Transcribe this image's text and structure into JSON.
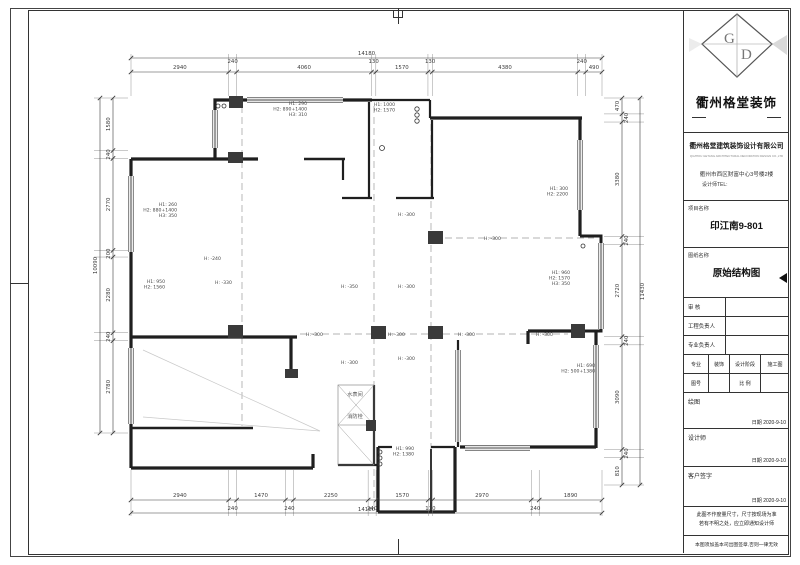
{
  "sheet": {
    "title_block": {
      "logo_letters": [
        "G",
        "D"
      ],
      "logo_text": "衢州格堂装饰",
      "company_name": "衢州格堂建筑装饰设计有限公司",
      "company_sub": "QUZHOU GETANG ARCHITECTURAL DECORATION DESIGN CO.,LTD",
      "address": "衢州市西区财富中心3号楼2楼",
      "tel_label": "设计师TEL:",
      "project_label": "项目名称",
      "project_name": "印江南9-801",
      "drawing_label": "图纸名称",
      "drawing_name": "原始结构图",
      "personnel_rows": [
        {
          "label": "审  核",
          "value": ""
        },
        {
          "label": "工程负责人",
          "value": ""
        },
        {
          "label": "专业负责人",
          "value": ""
        }
      ],
      "grid": {
        "major_label": "专业",
        "major_value": "装饰",
        "stage_label": "设计阶段",
        "stage_value": "施工图",
        "no_label": "图号",
        "no_value": "",
        "scale_label": "比 例",
        "scale_value": ""
      },
      "sign_boxes": [
        {
          "label": "绘图",
          "date_label": "日期",
          "date": "2020-9-10"
        },
        {
          "label": "设计师",
          "date_label": "日期",
          "date": "2020-9-10"
        },
        {
          "label": "客户签字",
          "date_label": "日期",
          "date": "2020-9-10"
        }
      ],
      "notes": [
        "此图不作度量尺寸，尺寸按现场为准",
        "若有不明之处，应立即通知设计师"
      ],
      "footer": "本图须加盖本司出图签章,否则一律无效"
    }
  },
  "plan": {
    "dimensions": {
      "top": {
        "overall": "14180",
        "segments": [
          "2940",
          "240",
          "4060",
          "130",
          "1570",
          "130",
          "4380",
          "240",
          "490"
        ]
      },
      "bottom": {
        "overall": "14180",
        "segments": [
          "2940",
          "240",
          "1470",
          "240",
          "2250",
          "240",
          "1570",
          "130",
          "2970",
          "240",
          "1890"
        ]
      },
      "left": {
        "overall": "10090",
        "segments": [
          "1580",
          "240",
          "2770",
          "200",
          "2280",
          "240",
          "2780"
        ]
      },
      "right": {
        "overall": "11430",
        "segments": [
          "470",
          "240",
          "3380",
          "240",
          "2720",
          "240",
          "3090",
          "240",
          "810"
        ]
      }
    },
    "beam_notes": [
      {
        "x": 307,
        "y": 105,
        "lines": [
          "H1: 290",
          "H2: 890+1400",
          "H3: 310"
        ]
      },
      {
        "x": 395,
        "y": 106,
        "lines": [
          "H1: 1000",
          "H2: 1570"
        ]
      },
      {
        "x": 177,
        "y": 206,
        "lines": [
          "H1: 260",
          "H2: 880+1400",
          "H3: 350"
        ]
      },
      {
        "x": 165,
        "y": 283,
        "lines": [
          "H1: 950",
          "H2: 1560"
        ]
      },
      {
        "x": 568,
        "y": 190,
        "lines": [
          "H1: 300",
          "H2: 2200"
        ]
      },
      {
        "x": 570,
        "y": 274,
        "lines": [
          "H1: 960",
          "H2: 1570",
          "H3: 350"
        ]
      },
      {
        "x": 595,
        "y": 367,
        "lines": [
          "H1: 690",
          "H2: 500+1380"
        ]
      },
      {
        "x": 414,
        "y": 450,
        "lines": [
          "H1: 990",
          "H2: 1380"
        ]
      }
    ],
    "level_notes": [
      {
        "x": 204,
        "y": 260,
        "text": "H: -240"
      },
      {
        "x": 215,
        "y": 284,
        "text": "H: -330"
      },
      {
        "x": 341,
        "y": 288,
        "text": "H: -350"
      },
      {
        "x": 398,
        "y": 216,
        "text": "H: -300"
      },
      {
        "x": 398,
        "y": 288,
        "text": "H: -300"
      },
      {
        "x": 484,
        "y": 240,
        "text": "H: -300"
      },
      {
        "x": 306,
        "y": 336,
        "text": "H: -300"
      },
      {
        "x": 388,
        "y": 336,
        "text": "H: -300"
      },
      {
        "x": 458,
        "y": 336,
        "text": "H: -300"
      },
      {
        "x": 536,
        "y": 336,
        "text": "H: -300"
      },
      {
        "x": 341,
        "y": 364,
        "text": "H: -300"
      },
      {
        "x": 398,
        "y": 360,
        "text": "H: -300"
      }
    ],
    "room_labels": [
      {
        "x": 355,
        "y": 396,
        "text": "水表间"
      },
      {
        "x": 355,
        "y": 418,
        "text": "消防栓"
      }
    ]
  }
}
